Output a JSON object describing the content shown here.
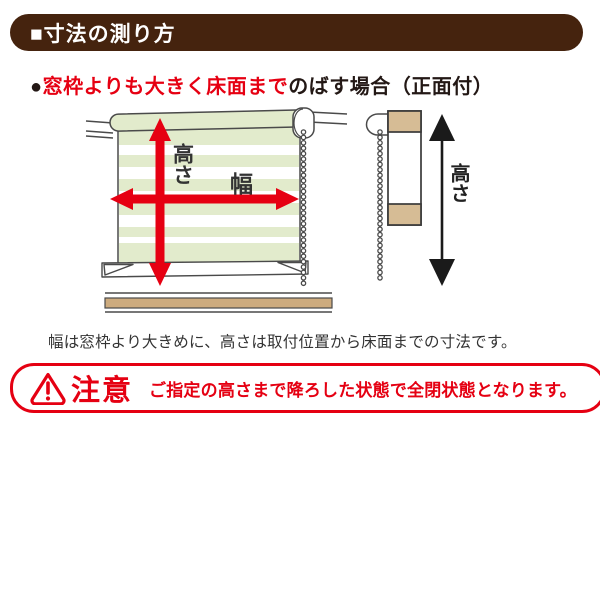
{
  "header": {
    "title": "■寸法の測り方",
    "bg_color": "#45230e",
    "text_color": "#ffffff"
  },
  "section_heading": {
    "bullet": "●",
    "highlight": "窓枠よりも大きく床面まで",
    "rest": "のばす場合（正面付）",
    "highlight_color": "#e60012"
  },
  "diagram": {
    "front_view": {
      "height_label": "高さ",
      "width_label": "幅"
    },
    "side_view": {
      "height_label": "高さ"
    },
    "colors": {
      "arrow_red": "#e60012",
      "blind_stripe_green": "#e2ebcc",
      "frame_tan": "#d6bc95",
      "floor_tan": "#cdab7e",
      "outline": "#4a4a4a",
      "side_arrow_black": "#1a1a1a"
    }
  },
  "caption": {
    "text": "幅は窓枠より大きめに、高さは取付位置から床面までの寸法です。"
  },
  "warning": {
    "label": "注意",
    "message": "ご指定の高さまで降ろした状態で全閉状態となります。",
    "color": "#e50012",
    "icon": "warning-triangle-icon"
  }
}
